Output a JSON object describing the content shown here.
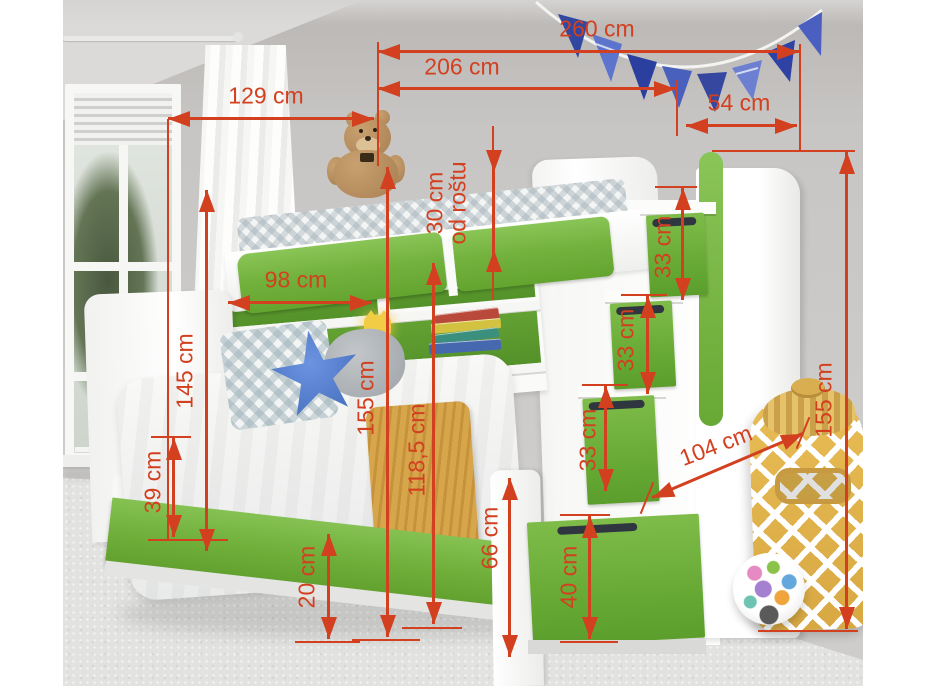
{
  "scene": {
    "title": "Children's bunk bed with trundle, shelves and stair drawers — dimension diagram",
    "unit": "cm"
  },
  "colors": {
    "dimension_red": "#d24020",
    "furniture_green": "#6fae39",
    "wall_gray": "#c8c6c4",
    "flag_blue": "#3a50b0",
    "blanket_yellow": "#d7a64b",
    "bag_yellow": "#e0b350"
  },
  "dimensions": {
    "total_width": "260 cm",
    "bed_length": "206 cm",
    "upper_bed_width": "129 cm",
    "stairs_width": "54 cm",
    "rail_above_slats": "30 cm",
    "rail_above_slats_note": "od roštu",
    "shelf_opening_width": "98 cm",
    "headboard_height": "145 cm",
    "mid_height": "155 cm",
    "lower_height": "118,5 cm",
    "trundle_front_height": "39 cm",
    "floor_clearance": "20 cm",
    "footboard_height": "66 cm",
    "stair_step_1": "33 cm",
    "stair_step_2": "33 cm",
    "stair_step_3": "33 cm",
    "stair_drawer_height": "40 cm",
    "depth": "104 cm",
    "total_height": "155 cm"
  }
}
